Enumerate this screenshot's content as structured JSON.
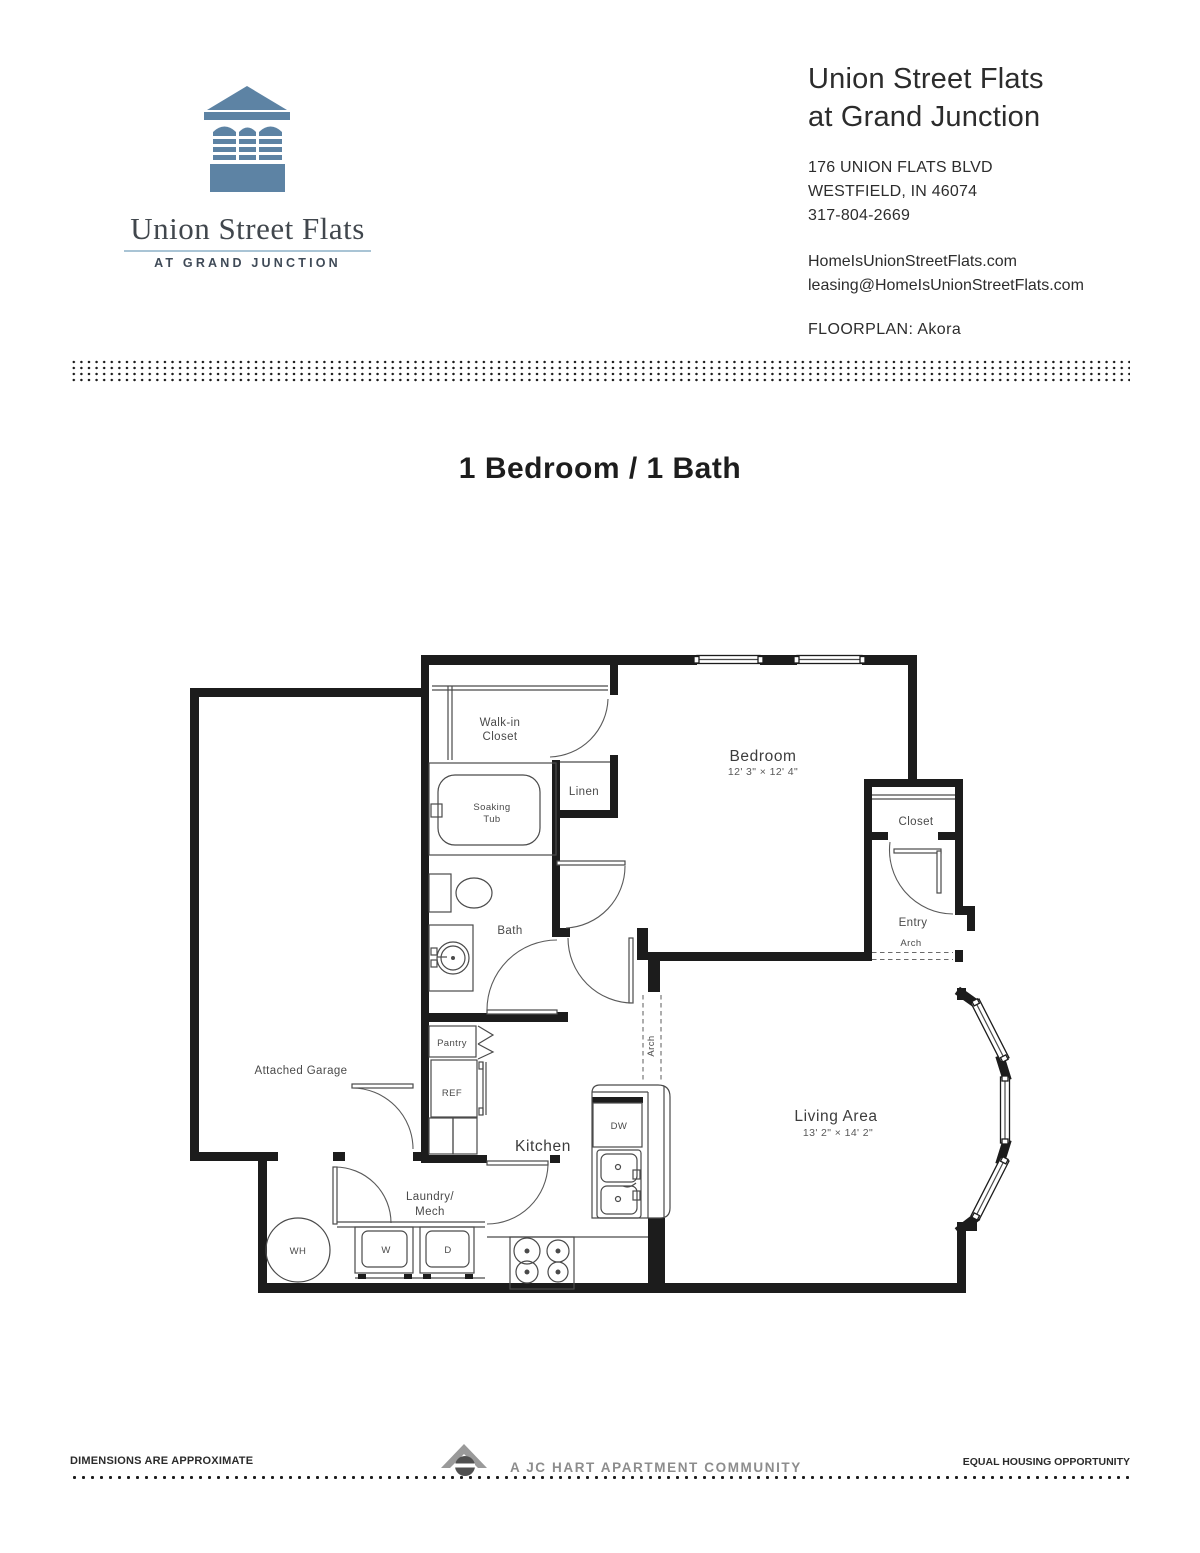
{
  "logo": {
    "brand": "Union Street Flats",
    "tagline": "AT GRAND JUNCTION"
  },
  "header": {
    "property_name_line1": "Union Street Flats",
    "property_name_line2": "at Grand Junction",
    "address_line1": "176 UNION FLATS BLVD",
    "address_line2": "WESTFIELD, IN 46074",
    "phone": "317-804-2669",
    "website": "HomeIsUnionStreetFlats.com",
    "email": "leasing@HomeIsUnionStreetFlats.com",
    "floorplan_label": "FLOORPLAN: Akora"
  },
  "page": {
    "title": "1 Bedroom / 1 Bath"
  },
  "floorplan": {
    "rooms": {
      "bedroom": {
        "name": "Bedroom",
        "dims": "12' 3\" × 12' 4\""
      },
      "living_area": {
        "name": "Living Area",
        "dims": "13' 2\" × 14' 2\""
      },
      "kitchen": "Kitchen",
      "bath": "Bath",
      "walk_in_closet_line1": "Walk-in",
      "walk_in_closet_line2": "Closet",
      "linen": "Linen",
      "soaking_tub_line1": "Soaking",
      "soaking_tub_line2": "Tub",
      "closet": "Closet",
      "entry": "Entry",
      "arch_entry": "Arch",
      "arch_kitchen": "Arch",
      "pantry": "Pantry",
      "ref": "REF",
      "dw": "DW",
      "attached_garage": "Attached Garage",
      "laundry_line1": "Laundry/",
      "laundry_line2": "Mech",
      "wh": "WH",
      "washer": "W",
      "dryer": "D"
    }
  },
  "footer": {
    "dimensions_note": "DIMENSIONS ARE APPROXIMATE",
    "community": "A JC HART APARTMENT COMMUNITY",
    "equal_housing": "EQUAL HOUSING OPPORTUNITY"
  },
  "colors": {
    "logo_blue": "#5d83a4",
    "brand_underline": "#a9c4d5",
    "ink": "#2d2d2d",
    "plan_wall": "#1c1c1c",
    "footer_gray": "#8d8d8d"
  }
}
